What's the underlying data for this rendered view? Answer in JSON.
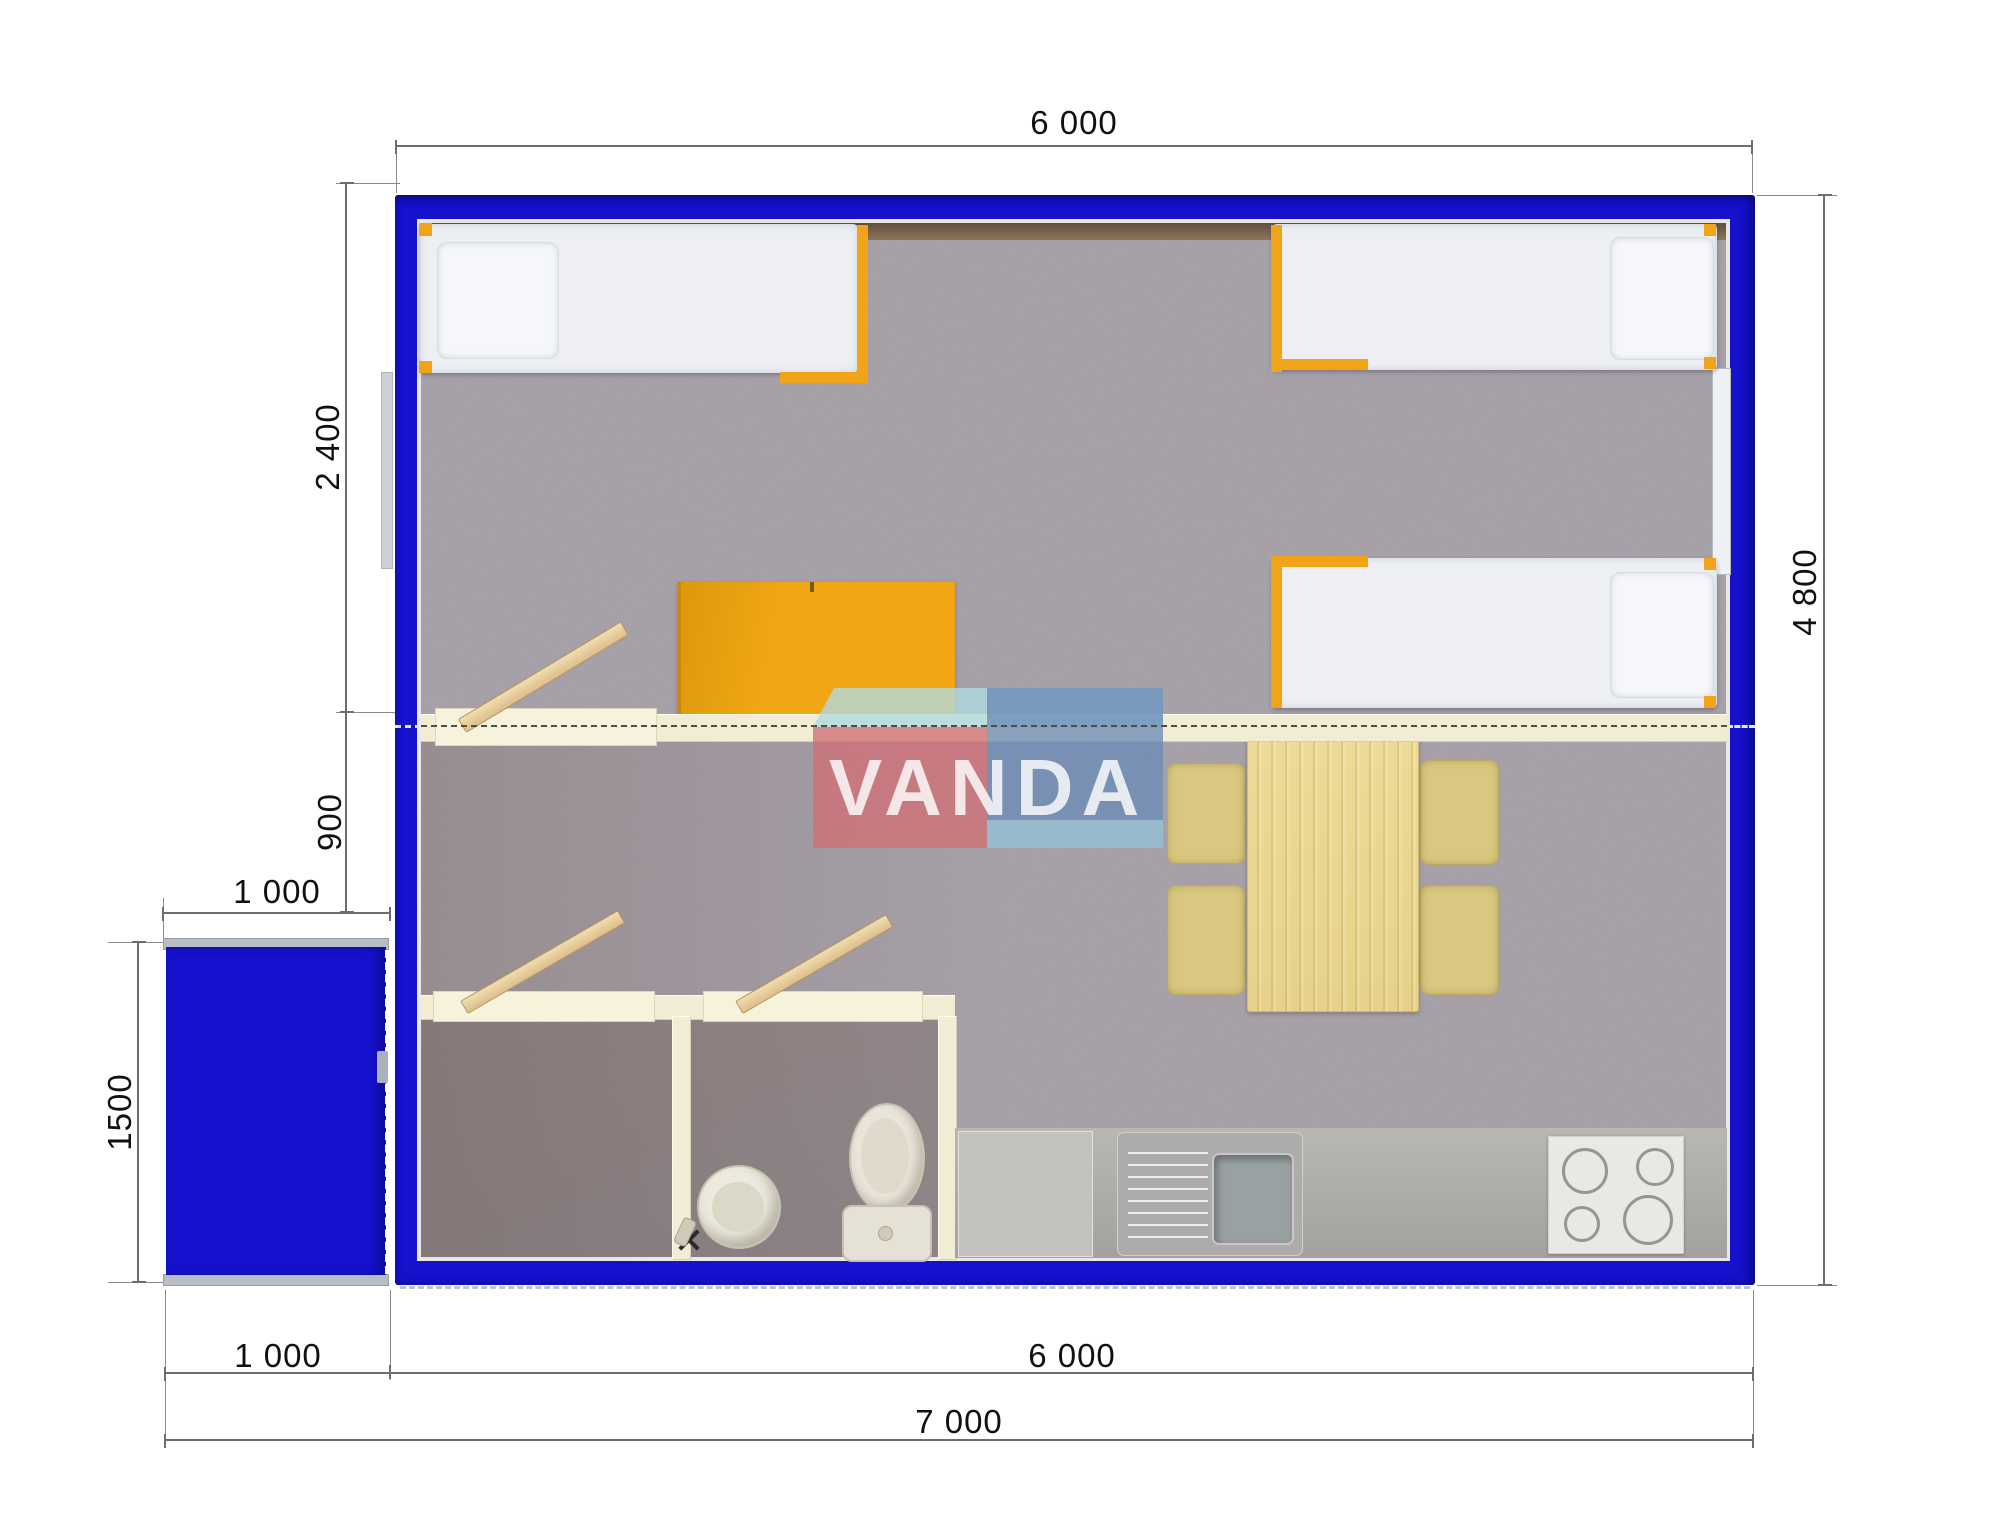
{
  "title": "Modular cabin floor plan 7000 x 4800 with porch",
  "watermark": {
    "text": "VANDA"
  },
  "dimensions": {
    "top_width": "6 000",
    "bedroom_depth": "2 400",
    "partition_offset": "900",
    "porch_width_top": "1 000",
    "porch_depth": "1500",
    "right_depth": "4 800",
    "bottom_porch_width": "1 000",
    "bottom_main_width": "6 000",
    "bottom_total_width": "7 000"
  },
  "colors": {
    "wall_blue": "#1511cd",
    "frame_orange": "#f2a418",
    "desk_yellow": "#f0a713",
    "wood_table": "#ead892",
    "chair_tan": "#d9c87f",
    "cream_wall": "#f1edd5",
    "floor_gray": "#a9a3ab",
    "counter_gray": "#b2b1ad",
    "logo_red": "#cf7077",
    "logo_blue": "#6c8cb6",
    "logo_cyan": "#b2dae0"
  },
  "furniture": {
    "beds": "3 single beds with orange frames",
    "desk": "yellow desk against partition wall",
    "dining": "wood dining table with 4 chairs",
    "bathroom": "washbasin and toilet",
    "kitchen": "counter with sink, drainboard and 4-burner stove",
    "porch": "blue entrance porch 1000 x 1500"
  }
}
